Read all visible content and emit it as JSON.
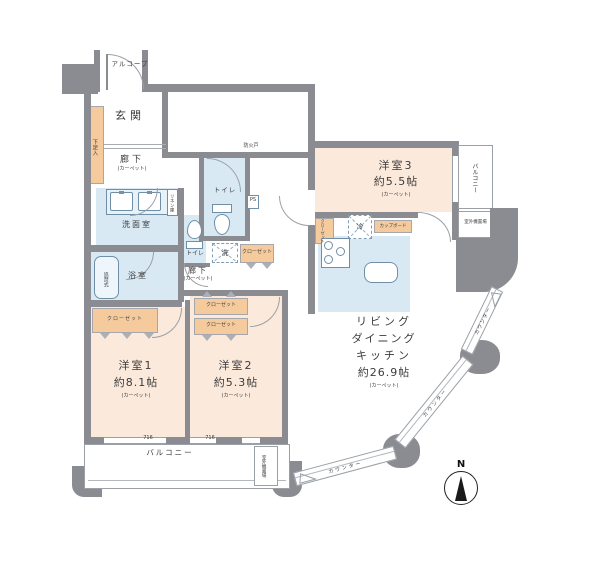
{
  "colors": {
    "wall": "#8b8b92",
    "bedroom_fill": "#fbe9dc",
    "wet_area_fill": "#d9e9f3",
    "closet_fill": "#f5cb9e",
    "outline": "#9aa0a6"
  },
  "rooms": {
    "alcove": "アルコーブ",
    "genkan": "玄関",
    "shoe": "下足入",
    "hall_upper": {
      "name": "廊下",
      "floor": "(カーペット)"
    },
    "hall_mid": {
      "name": "廊下",
      "floor": "(カーペット)"
    },
    "washroom": "洗面室",
    "linen": "リネン庫",
    "toilet_a": "トイレ",
    "toilet_b": "トイレ",
    "ps": "PS",
    "laundry": "洗",
    "fridge": "冷",
    "bath": "浴室",
    "tub": "追焚式",
    "fire_door": "防火戸",
    "closet_hall": "クローゼット",
    "closet_bed1": "クローゼット",
    "closet_bed2_upper": "クローゼット",
    "closet_bed2_lower": "クローゼット",
    "closet_bed3": "クローゼット",
    "cupboard": "カップボード",
    "bed1": {
      "name": "洋室1",
      "size": "約8.1帖",
      "floor": "(カーペット)"
    },
    "bed2": {
      "name": "洋室2",
      "size": "約5.3帖",
      "floor": "(カーペット)"
    },
    "bed3": {
      "name": "洋室3",
      "size": "約5.5帖",
      "floor": "(カーペット)"
    },
    "ldk": {
      "line1": "リビング",
      "line2": "ダイニング",
      "line3": "キッチン",
      "size": "約26.9帖",
      "floor": "(カーペット)"
    },
    "balcony_right": "バルコニー",
    "balcony_bottom": "バルコニー",
    "ac_right": "室外機置場",
    "ac_bottom": "室外機置場",
    "counter_1": "カウンター",
    "counter_2": "カウンター",
    "counter_3": "カウンター",
    "window_code_1": "716",
    "window_code_2": "716",
    "compass_n": "N"
  }
}
